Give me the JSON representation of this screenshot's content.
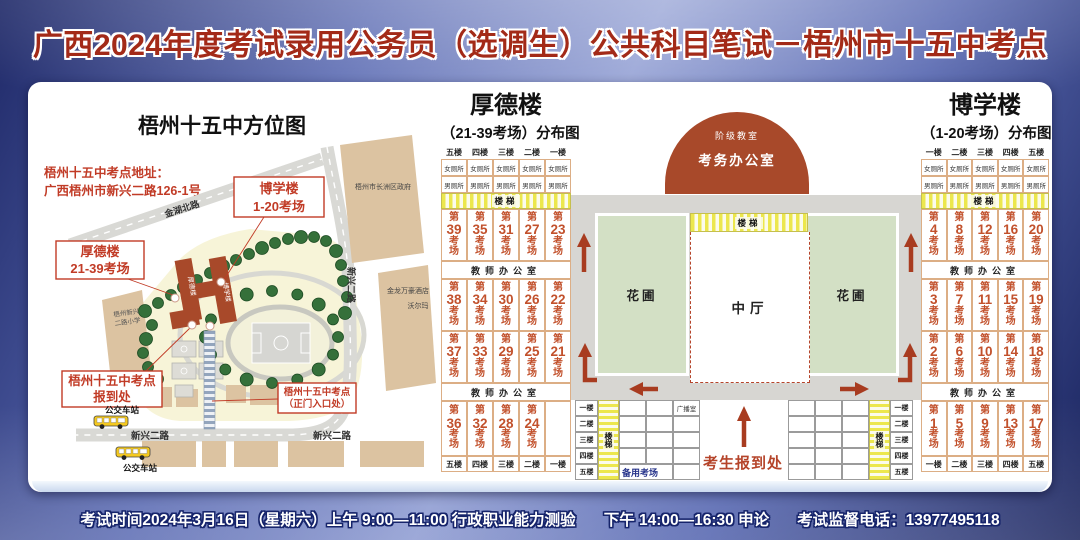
{
  "title": "广西2024年度考试录用公务员（选调生）公共科目笔试－梧州市十五中考点",
  "footer": {
    "morning": "考试时间2024年3月16日（星期六）上午 9:00—11:00 行政职业能力测验",
    "afternoon": "下午 14:00—16:30 申论",
    "phone": "考试监督电话：13977495118"
  },
  "map": {
    "title": "梧州十五中方位图",
    "address1": "梧州十五中考点地址：",
    "address2": "广西梧州市新兴二路126-1号",
    "callout_boxue": [
      "博学楼",
      "1-20考场"
    ],
    "callout_houde": [
      "厚德楼",
      "21-39考场"
    ],
    "callout_checkin": [
      "梧州十五中考点",
      "报到处"
    ],
    "callout_gate": [
      "梧州十五中考点",
      "（正门入口处）"
    ],
    "road_jinhu": "金湖北路",
    "road_xinxing": "新兴二路",
    "poi_government": "梧州市长洲区政府",
    "poi_hotel": "金龙万豪酒店",
    "poi_walmart": "沃尔玛",
    "poi_school": [
      "梧州新兴",
      "二路小学"
    ],
    "bus_station": "公交车站",
    "building_houde": "厚德楼",
    "building_boxue": "博学楼"
  },
  "common": {
    "stairs": "楼梯",
    "teacher_office": "教师办公室",
    "toilet_female": "女厕所",
    "toilet_male": "男厕所",
    "room_char_1": "第",
    "room_char_2": "考",
    "room_char_3": "场",
    "floors_asc": [
      "一楼",
      "二楼",
      "三楼",
      "四楼",
      "五楼"
    ],
    "floors_desc": [
      "五楼",
      "四楼",
      "三楼",
      "二楼",
      "一楼"
    ]
  },
  "houde": {
    "name": "厚德楼",
    "subtitle": "（21-39考场）分布图",
    "floor_order": "desc",
    "room_rows": [
      [
        39,
        35,
        31,
        27,
        23
      ],
      [
        38,
        34,
        30,
        26,
        22
      ],
      [
        37,
        33,
        29,
        25,
        21
      ],
      [
        36,
        32,
        28,
        24,
        null
      ]
    ]
  },
  "boxue": {
    "name": "博学楼",
    "subtitle": "（1-20考场）分布图",
    "floor_order": "asc",
    "room_rows": [
      [
        4,
        8,
        12,
        16,
        20
      ],
      [
        3,
        7,
        11,
        15,
        19
      ],
      [
        2,
        6,
        10,
        14,
        18
      ],
      [
        1,
        5,
        9,
        13,
        17
      ]
    ]
  },
  "courtyard": {
    "lecture_hall": "阶级教室",
    "exam_office": "考务办公室",
    "flower_bed": "花圃",
    "central_hall": "中厅",
    "checkin": "考生报到处",
    "broadcast_room": "广播室",
    "backup_room": "备用考场"
  },
  "colors": {
    "accent_red": "#b5442a",
    "room_text": "#c2512c",
    "cell_border": "#dcae85",
    "stairs_yellow": "#ece74d",
    "flower_green": "#d3e0c5",
    "corridor_gray": "#d7d6d2",
    "building_red": "#a8492a",
    "campus_cream": "#f7f4d8",
    "map_building_tan": "#dcc3a1"
  }
}
